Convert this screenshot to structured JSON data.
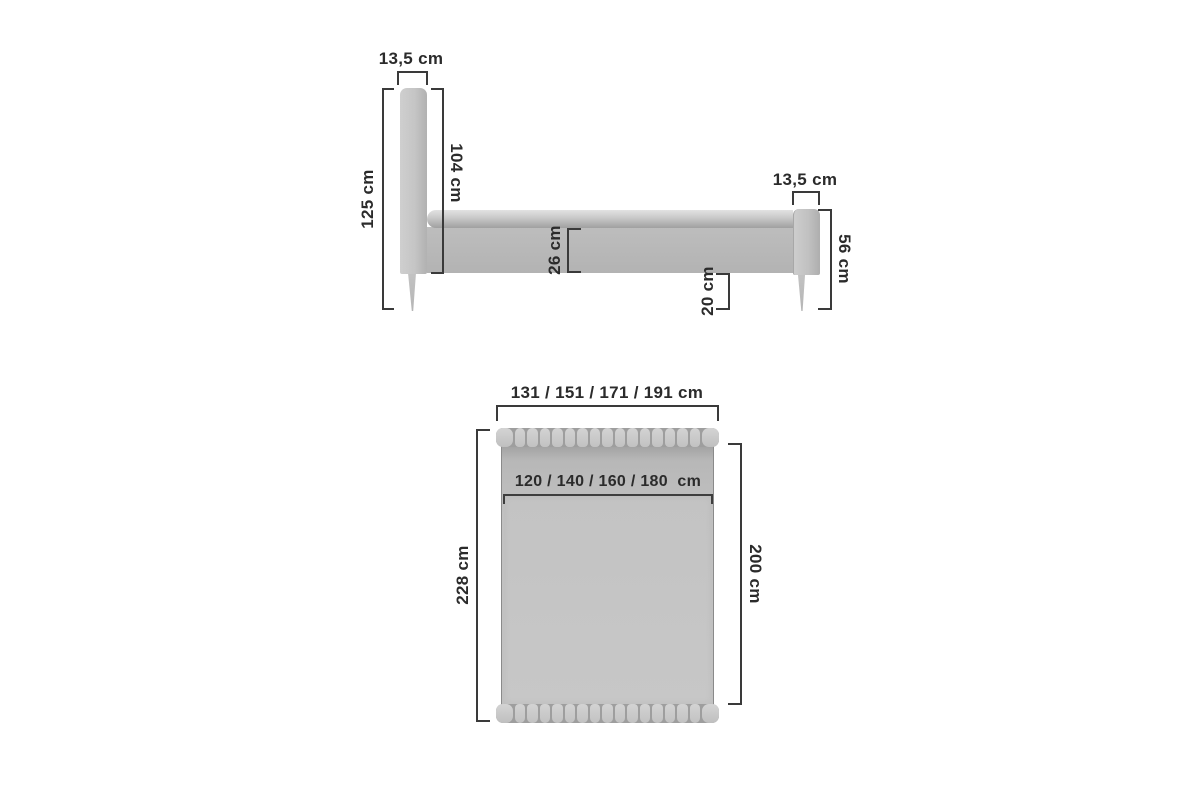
{
  "diagram": {
    "title": "bed-dimensions-diagram",
    "unit": "cm",
    "side_view": {
      "headboard_thickness": "13,5 cm",
      "total_height": "125 cm",
      "headboard_above_base_height": "104 cm",
      "frame_side_height": "26 cm",
      "underbed_clearance": "20 cm",
      "footboard_thickness": "13,5 cm",
      "footboard_height": "56 cm"
    },
    "top_view": {
      "overall_width_options": "131 / 151 / 171 / 191 cm",
      "mattress_width_options": "120 / 140 / 160 / 180  cm",
      "overall_length": "228 cm",
      "mattress_length": "200 cm"
    },
    "colors": {
      "background": "#ffffff",
      "upholstery_light": "#cdcdcd",
      "upholstery_mid": "#b9b9b9",
      "dimension_line": "#3a3a3a",
      "text": "#2b2b2b"
    }
  }
}
